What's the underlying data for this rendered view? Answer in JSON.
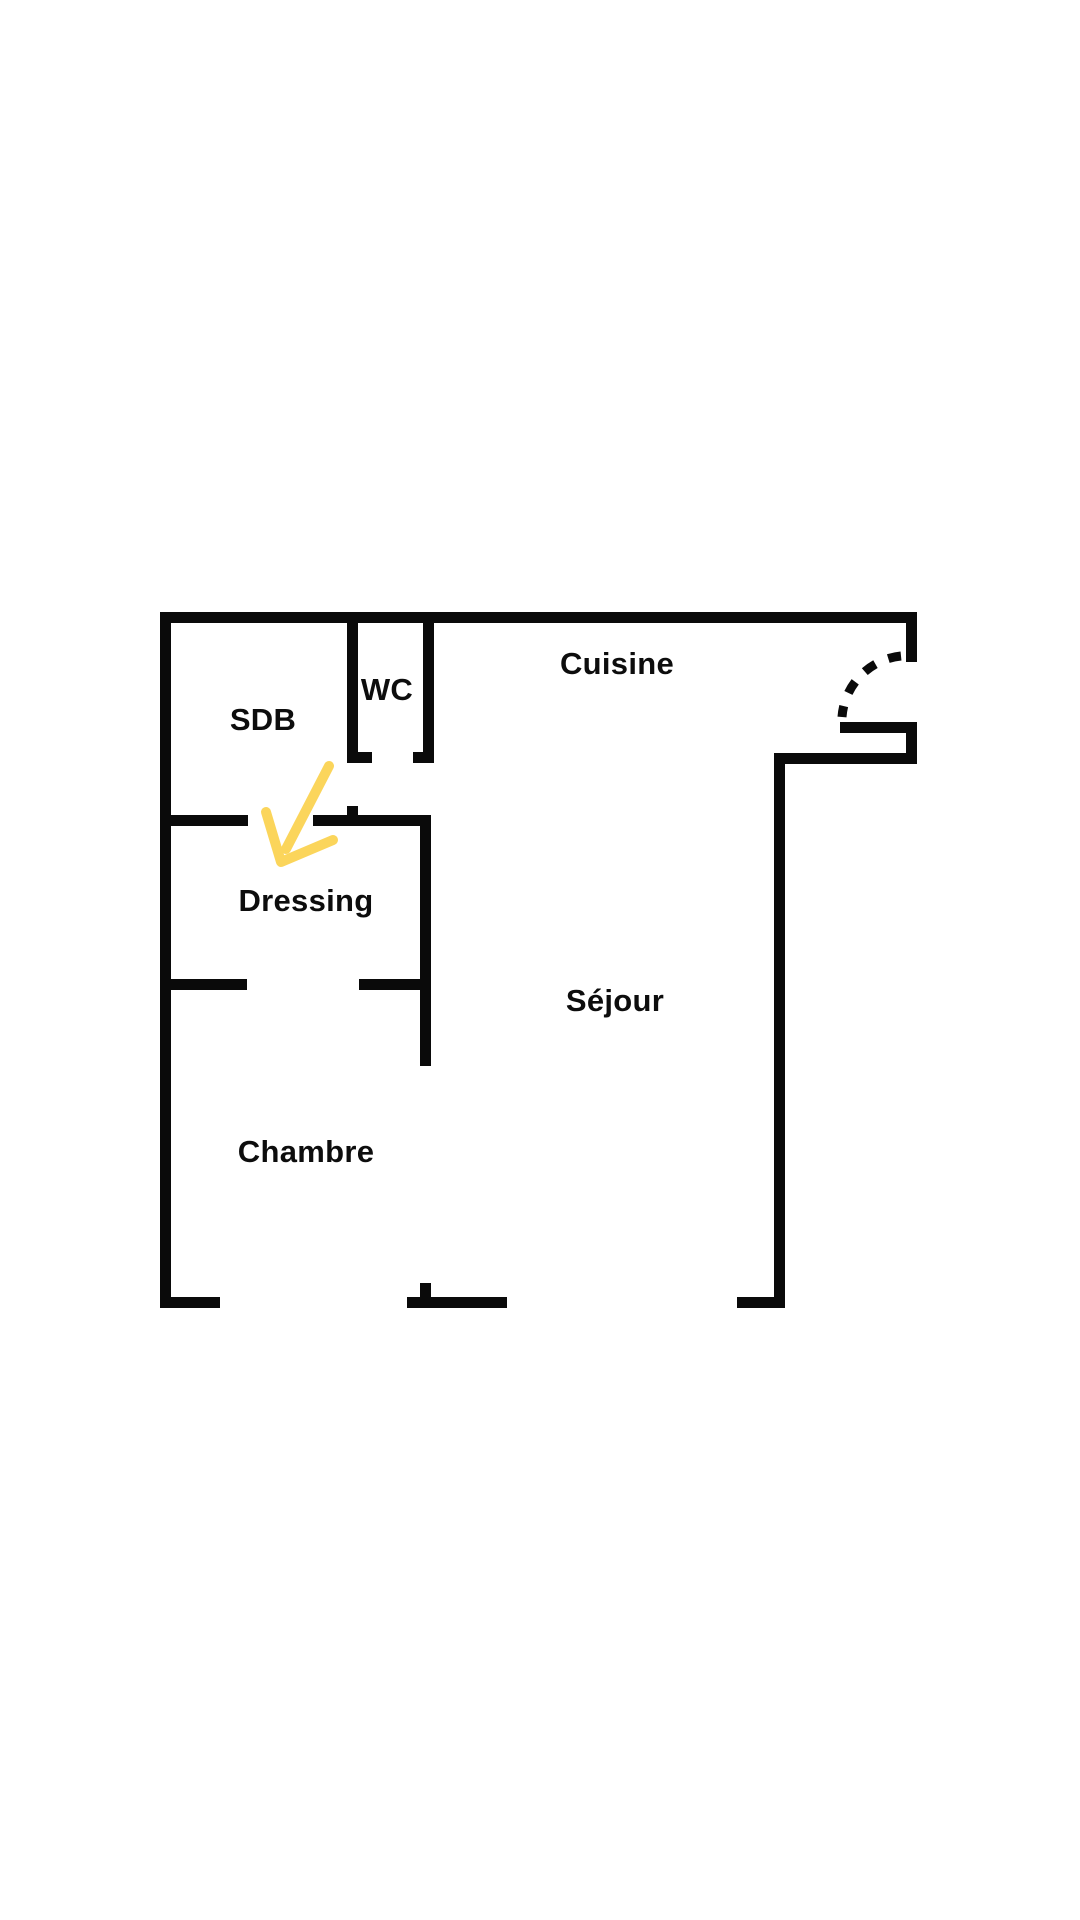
{
  "page": {
    "background": "#ffffff",
    "width": 1080,
    "height": 1920
  },
  "floorplan": {
    "wall_color": "#0a0a0a",
    "text_color": "#0d0d0d",
    "label_font_size": 31,
    "walls": [
      {
        "id": "top-wall",
        "x": 160,
        "y": 612,
        "w": 757,
        "h": 11
      },
      {
        "id": "left-wall",
        "x": 160,
        "y": 612,
        "w": 11,
        "h": 696
      },
      {
        "id": "bottom-wall-left",
        "x": 160,
        "y": 1297,
        "w": 60,
        "h": 11
      },
      {
        "id": "bottom-wall-center",
        "x": 407,
        "y": 1297,
        "w": 100,
        "h": 11
      },
      {
        "id": "bottom-wall-center-jamb",
        "x": 420,
        "y": 1283,
        "w": 11,
        "h": 14
      },
      {
        "id": "bottom-wall-right",
        "x": 737,
        "y": 1297,
        "w": 48,
        "h": 11
      },
      {
        "id": "right-wall-upper",
        "x": 906,
        "y": 612,
        "w": 11,
        "h": 50
      },
      {
        "id": "entry-stub-wall",
        "x": 840,
        "y": 722,
        "w": 77,
        "h": 11
      },
      {
        "id": "right-wall-mid",
        "x": 906,
        "y": 722,
        "w": 11,
        "h": 42
      },
      {
        "id": "entry-inset-wall",
        "x": 774,
        "y": 753,
        "w": 143,
        "h": 11
      },
      {
        "id": "sejour-right-wall",
        "x": 774,
        "y": 753,
        "w": 11,
        "h": 555
      },
      {
        "id": "wc-left-wall",
        "x": 347,
        "y": 623,
        "w": 11,
        "h": 140
      },
      {
        "id": "wc-left-door-jamb",
        "x": 347,
        "y": 752,
        "w": 25,
        "h": 11
      },
      {
        "id": "wc-right-wall",
        "x": 423,
        "y": 623,
        "w": 11,
        "h": 140
      },
      {
        "id": "wc-right-door-jamb",
        "x": 413,
        "y": 752,
        "w": 21,
        "h": 11
      },
      {
        "id": "sdb-dressing-wall-left",
        "x": 160,
        "y": 815,
        "w": 88,
        "h": 11
      },
      {
        "id": "sdb-dressing-wall-right",
        "x": 313,
        "y": 815,
        "w": 118,
        "h": 11
      },
      {
        "id": "sdb-dressing-wall-jamb",
        "x": 347,
        "y": 806,
        "w": 11,
        "h": 9
      },
      {
        "id": "dressing-right-wall",
        "x": 420,
        "y": 815,
        "w": 11,
        "h": 251
      },
      {
        "id": "dressing-chambre-wall-left",
        "x": 160,
        "y": 979,
        "w": 87,
        "h": 11
      },
      {
        "id": "dressing-chambre-wall-right",
        "x": 359,
        "y": 979,
        "w": 72,
        "h": 11
      }
    ],
    "door_arc": {
      "id": "entrance-door-swing",
      "sx": 901,
      "sy": 656,
      "ex": 842,
      "ey": 717,
      "r": 66,
      "stroke_width": 9,
      "dash": "13 14"
    },
    "arrow": {
      "id": "dressing-pointer-arrow",
      "color": "#FBD55B",
      "stroke_width": 10,
      "shaft": [
        [
          329,
          766
        ],
        [
          286,
          849
        ]
      ],
      "head": [
        [
          266,
          812
        ],
        [
          281,
          862
        ],
        [
          333,
          840
        ]
      ]
    },
    "rooms": [
      {
        "id": "cuisine",
        "label": "Cuisine",
        "x": 617,
        "y": 664
      },
      {
        "id": "wc",
        "label": "WC",
        "x": 387,
        "y": 690
      },
      {
        "id": "sdb",
        "label": "SDB",
        "x": 263,
        "y": 720
      },
      {
        "id": "dressing",
        "label": "Dressing",
        "x": 306,
        "y": 901
      },
      {
        "id": "sejour",
        "label": "Séjour",
        "x": 615,
        "y": 1001
      },
      {
        "id": "chambre",
        "label": "Chambre",
        "x": 306,
        "y": 1152
      }
    ]
  }
}
